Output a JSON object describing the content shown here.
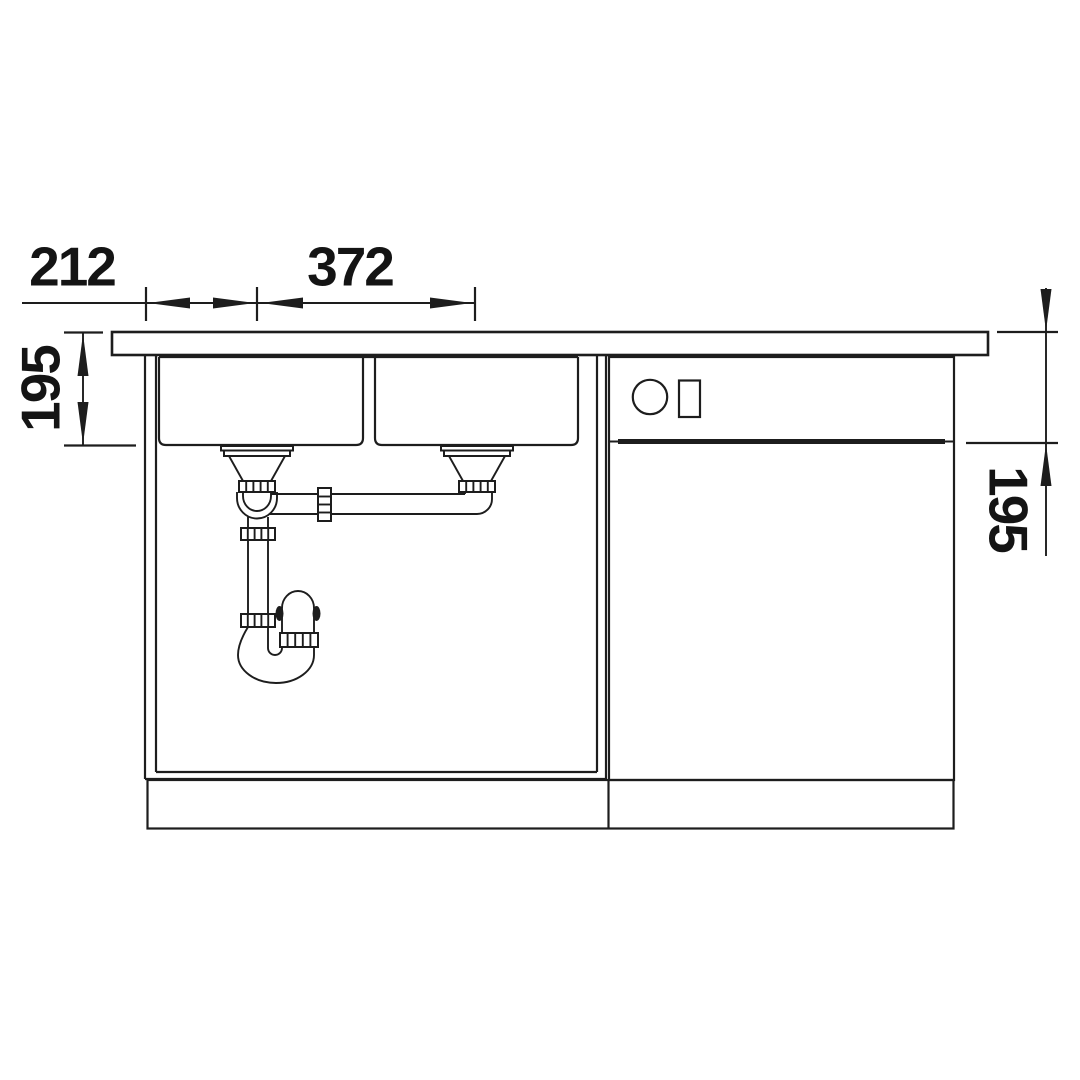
{
  "drawing": {
    "background_color": "#ffffff",
    "line_color": "#1d1d1d",
    "kind": "sink-cabinet-front-elevation"
  },
  "dimensions": {
    "top_left": {
      "label": "212",
      "orientation": "horizontal"
    },
    "top_center": {
      "label": "372",
      "orientation": "horizontal"
    },
    "left": {
      "label": "195",
      "orientation": "vertical"
    },
    "right": {
      "label": "195",
      "orientation": "vertical"
    }
  }
}
